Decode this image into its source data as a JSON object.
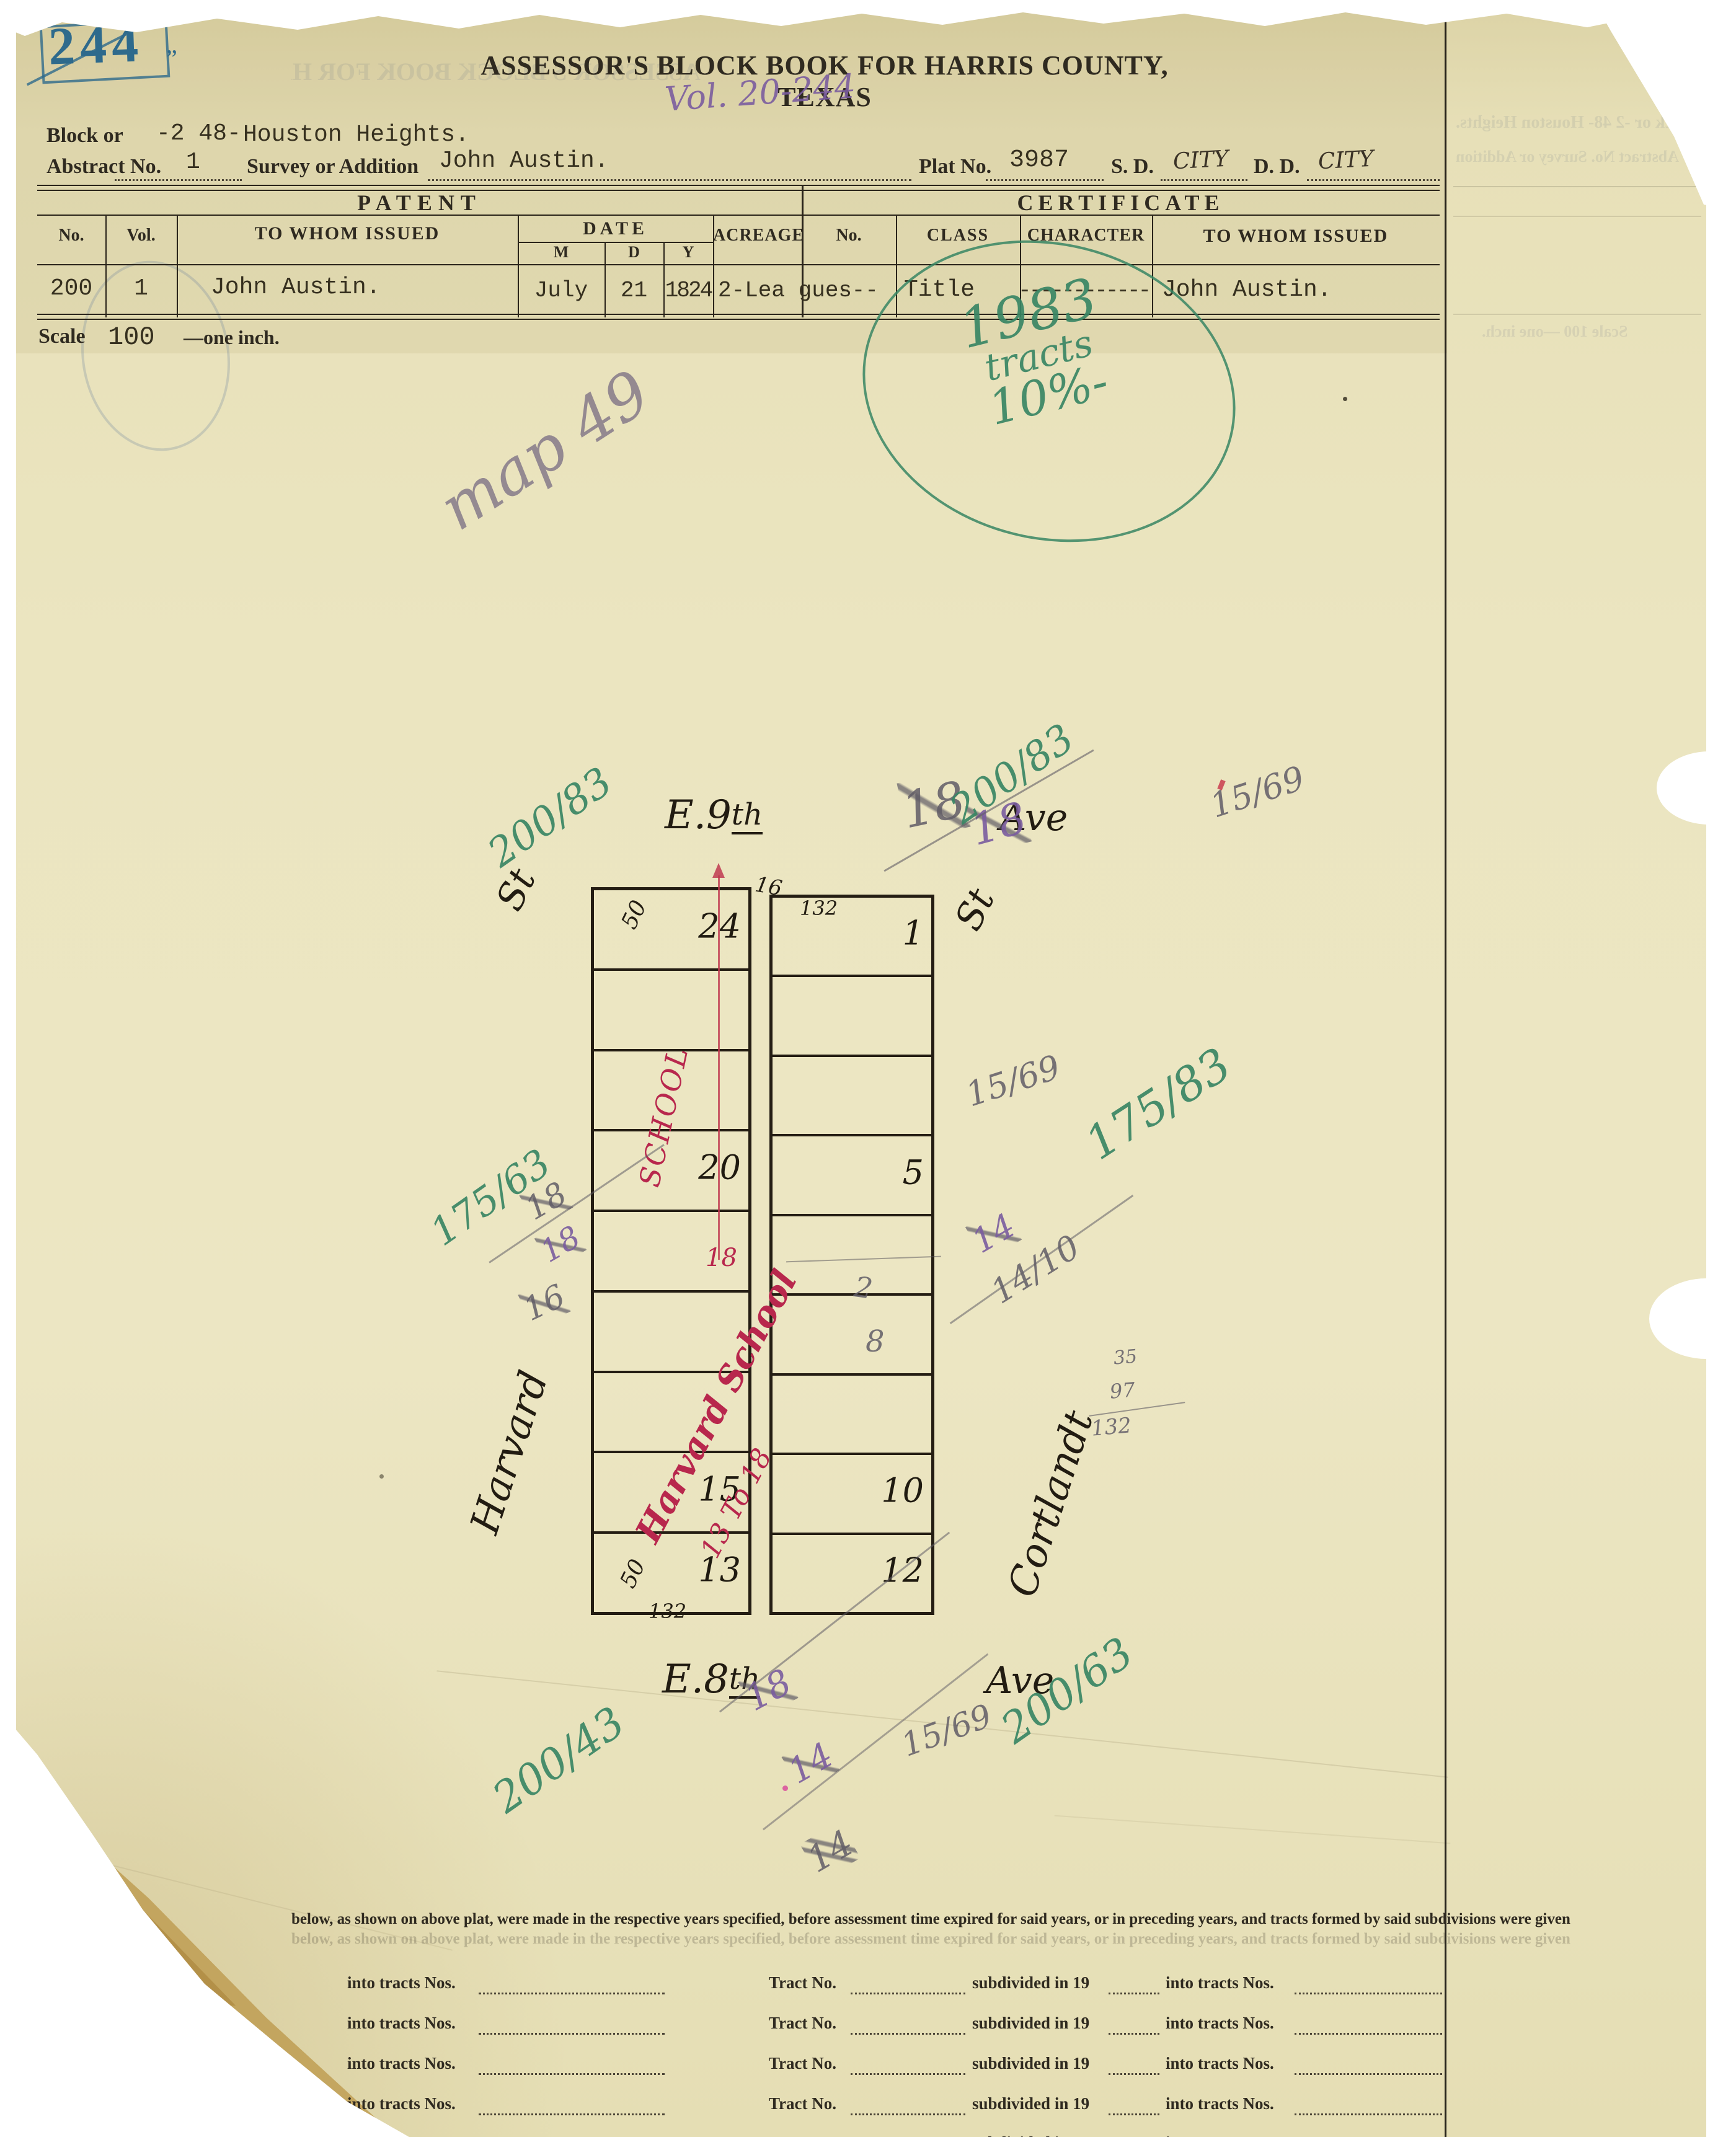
{
  "page": {
    "stamp_number": "244",
    "ditto": "„",
    "title": "ASSESSOR'S BLOCK BOOK FOR HARRIS COUNTY, TEXAS",
    "vol_note": "Vol. 20-244"
  },
  "header": {
    "block_label": "Block or",
    "block_value": "-2 48-",
    "block_addition": "Houston Heights.",
    "abstract_label": "Abstract No.",
    "abstract_value": "1",
    "survey_label": "Survey or Addition",
    "survey_value": "John Austin.",
    "plat_label": "Plat No.",
    "plat_value": "3987",
    "sd_label": "S. D.",
    "sd_value": "CITY",
    "dd_label": "D. D.",
    "dd_value": "CITY"
  },
  "patent": {
    "title": "PATENT",
    "col_no": "No.",
    "col_vol": "Vol.",
    "col_issued": "TO WHOM ISSUED",
    "col_date": "DATE",
    "col_m": "M",
    "col_d": "D",
    "col_y": "Y",
    "col_acreage": "ACREAGE",
    "row": {
      "no": "200",
      "vol": "1",
      "issued": "John Austin.",
      "m": "July",
      "d": "21",
      "y": "1824",
      "acreage": "2-Lea gues"
    }
  },
  "certificate": {
    "title": "CERTIFICATE",
    "col_no": "No.",
    "col_class": "CLASS",
    "col_character": "CHARACTER",
    "col_issued": "TO WHOM ISSUED",
    "row": {
      "no": "---",
      "class": "Title",
      "character": "------------",
      "issued": "John Austin."
    }
  },
  "scale": {
    "label": "Scale",
    "value": "100",
    "suffix": "—one inch."
  },
  "annotations": {
    "green_circle_line1": "1983",
    "green_circle_line2": "tracts",
    "green_circle_line3": "10%-",
    "map_note": "map 49",
    "fr_tl": "200/83",
    "fr_tr": "200/83",
    "fr_ml": "175/63",
    "fr_mr": "175/83",
    "fr_bl": "200/43",
    "fr_br": "200/63",
    "p_top_a": "18",
    "p_top_b": "18",
    "p_top_c": "15/69",
    "p_left_a": "18",
    "p_left_b": "18",
    "p_left_c": "16",
    "p_right_a": "15/69",
    "p_right_b": "14",
    "p_right_c": "14/10",
    "sum_a": "35",
    "sum_b": "97",
    "sum_c": "132",
    "p_block_a": "2",
    "p_block_b": "8",
    "p_bot_a": "18",
    "p_bot_b": "14",
    "p_bot_c": "14",
    "p_bot_d": "15/69"
  },
  "plat": {
    "street_top_main": "E.9",
    "street_top_sup": "th",
    "street_top_ave": "Ave",
    "street_bottom_main": "E.8",
    "street_bottom_sup": "th",
    "street_bottom_ave": "Ave",
    "street_left": "Harvard",
    "street_right": "Cortlandt",
    "st_left": "St",
    "st_right": "St",
    "dim_50_top": "50",
    "dim_132_top": "132",
    "dim_16": "16",
    "dim_50_bottom": "50",
    "dim_132_bottom": "132",
    "left_rows": [
      "24",
      "",
      "",
      "20",
      "",
      "",
      "",
      "15",
      "13"
    ],
    "right_rows": [
      "1",
      "",
      "",
      "5",
      "",
      "",
      "",
      "10",
      "12"
    ],
    "red_school": "SCHOOL",
    "red_harvard_school": "Harvard School",
    "red_13to18": "13 To 18",
    "red_18": "18"
  },
  "form": {
    "intro": "below, as shown on above plat, were made in the respective years specified, before assessment time expired for said years, or in preceding years, and tracts formed by said subdivisions were given",
    "left_label": "into tracts Nos.",
    "tract_label": "Tract No.",
    "subdivided_label": "subdivided in 19",
    "into_label": "into tracts Nos.",
    "row_count": 5
  }
}
